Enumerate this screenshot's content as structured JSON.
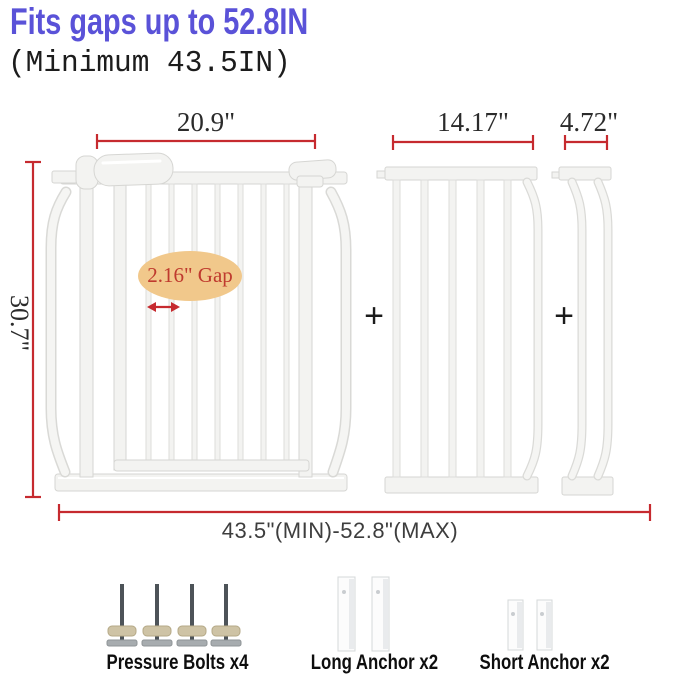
{
  "header": {
    "title": "Fits gaps up to 52.8IN",
    "subtitle": "(Minimum 43.5IN)"
  },
  "dimensions": {
    "gate_width": "20.9\"",
    "gate_height": "30.7\"",
    "gap": "2.16\" Gap",
    "extension_large_width": "14.17\"",
    "extension_small_width": "4.72\"",
    "total_range": "43.5\"(MIN)-52.8\"(MAX)"
  },
  "operators": {
    "plus": "+"
  },
  "hardware": {
    "pressure_bolts": {
      "label": "Pressure Bolts x4"
    },
    "long_anchor": {
      "label": "Long Anchor x2"
    },
    "short_anchor": {
      "label": "Short Anchor x2"
    }
  },
  "colors": {
    "title_blue": "#5a52d8",
    "dimension_red": "#c62a2f",
    "gap_bubble_fill": "#f1c88b",
    "gap_text_red": "#bf3a2e",
    "metal_white": "#f3f3f1",
    "bolt_stem_gray": "#4d5358",
    "bolt_knob_tan": "#cec3a5",
    "label_black": "#0e0e0e"
  }
}
